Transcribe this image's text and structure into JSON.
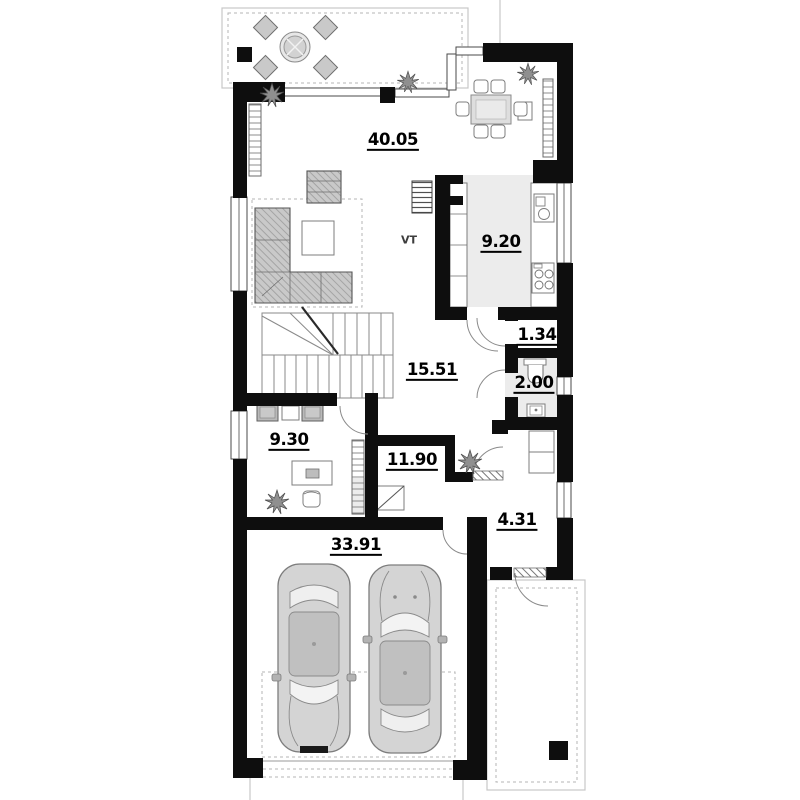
{
  "plan": {
    "type": "architectural-floor-plan",
    "colors": {
      "wall": "#0e0e0e",
      "shade": "#ececec",
      "line": "#9a9a9a",
      "furniture": "#c9c9c9"
    },
    "rooms": [
      {
        "id": "living-dining-room",
        "area": "40.05"
      },
      {
        "id": "kitchen",
        "area": "9.20"
      },
      {
        "id": "ventilation-shaft",
        "area": "VT"
      },
      {
        "id": "closet",
        "area": "1.34"
      },
      {
        "id": "wc",
        "area": "2.00"
      },
      {
        "id": "hall",
        "area": "15.51"
      },
      {
        "id": "office",
        "area": "9.30"
      },
      {
        "id": "utility-room",
        "area": "11.90"
      },
      {
        "id": "vestibule",
        "area": "4.31"
      },
      {
        "id": "garage",
        "area": "33.91"
      }
    ]
  }
}
